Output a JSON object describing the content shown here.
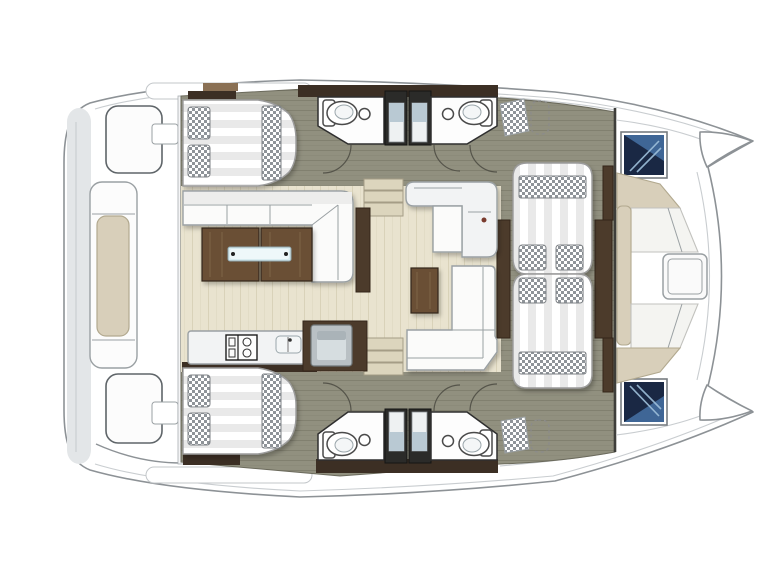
{
  "title": "catamaran-deck-floor-plan",
  "palette": {
    "page_bg": "#ffffff",
    "hull_fill": "#ffffff",
    "hull_line": "#8d9296",
    "hull_line_soft": "#c9cdd0",
    "stern_gray": "#e3e6e8",
    "cockpit_line": "#5f6569",
    "divider_wall": "#3c2f24",
    "wall_tan": "#8a7054",
    "wood": "#6a4f36",
    "wood_dark": "#4c3b2b",
    "wood_stroke": "#33261a",
    "wood_streak": "#7d6145",
    "floor_saloon": "#e9e3cf",
    "floor_saloon_line": "#d9d2b9",
    "floor_corridor": "#91907f",
    "floor_corridor_line": "#81806f",
    "furn_white": "#fbfbfa",
    "furn_stroke": "#9aa0a3",
    "furn_shade": "#ededec",
    "bed_white": "#ffffff",
    "bed_stripe": "#e9e9e9",
    "checker": "#8f9499",
    "seat_beige": "#d8cfba",
    "seat_beige_line": "#b2a98f",
    "navy": "#1a2844",
    "navy_light": "#3f6696",
    "navy_streak": "#9fc0da",
    "shower_dark": "#2b2b29",
    "shower_glass": "#b9c9d3",
    "metal": "#b9c0c4",
    "metal_light": "#d6dde0",
    "glass": "#d8ecf0",
    "step": "#dcd5bd",
    "arc": "#55544a",
    "fixture_stroke": "#4a4a4a",
    "faucet_red": "#7a3b2e"
  },
  "features": [
    "stern-swim-platform",
    "aft-cockpit",
    "aft-bench",
    "port-aft-berth",
    "starboard-aft-berth",
    "saloon-l-sofa",
    "coffee-table",
    "chaise-l-sofa",
    "tv-cabinet",
    "galley-counter",
    "stove",
    "galley-sink",
    "galley-appliance",
    "companionway-steps-port",
    "companionway-steps-starboard",
    "head-toilet",
    "head-washbasin",
    "shower-stall",
    "forward-berth-port",
    "forward-berth-starboard",
    "wardrobe",
    "deck-sunpad",
    "bow-hatch",
    "foredeck-lounge",
    "foredeck-table",
    "bow-tip"
  ]
}
